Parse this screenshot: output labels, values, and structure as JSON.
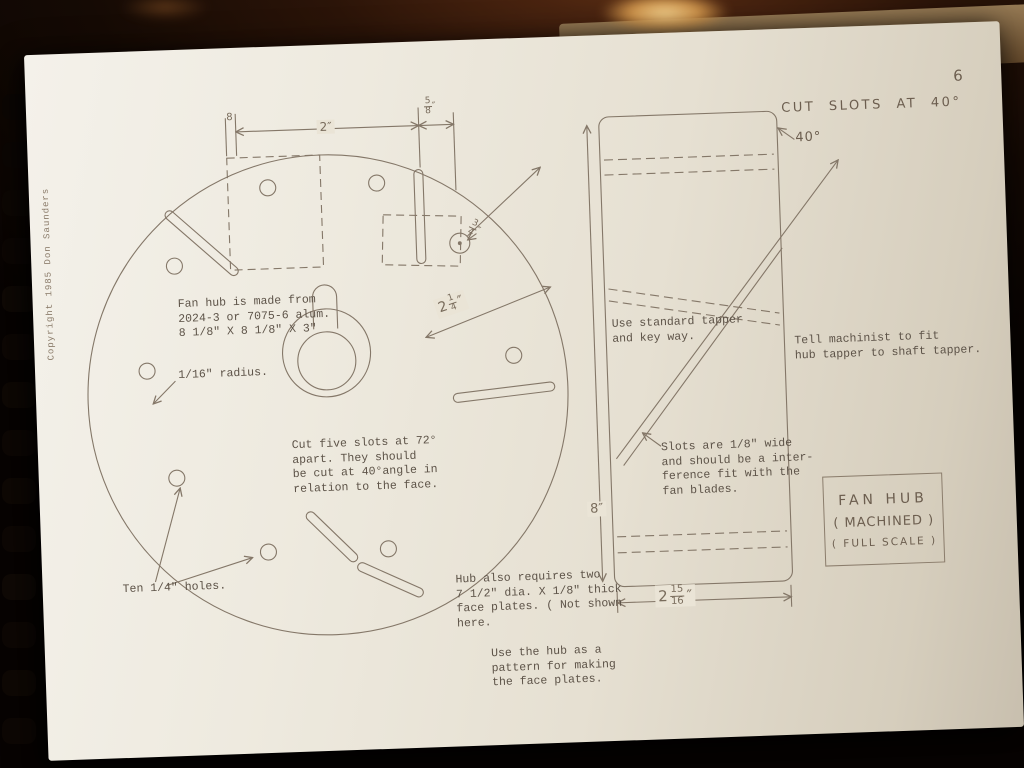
{
  "page_number": "6",
  "copyright": "Copyright 1985 Don Saunders",
  "face_view": {
    "dim_8": "8",
    "dim_2": "2″",
    "dim_5_8": {
      "num": "5",
      "den": "8",
      "unit": "″"
    },
    "dim_3_4": {
      "num": "3",
      "den": "4",
      "unit": "″"
    },
    "dim_2_1_4": {
      "whole": "2",
      "num": "1",
      "den": "4",
      "unit": "″"
    },
    "material_note": "Fan hub is made from\n2024-3 or 7075-6 alum.\n8 1/8\" X 8 1/8\" X 3\"",
    "radius_note": "1/16\" radius.",
    "slots_note": "Cut five slots at 72°\napart.  They should\nbe cut at 40°angle in\nrelation to the face.",
    "holes_note": "Ten 1/4\" holes.",
    "face_plates_note": "Hub also requires two\n7 1/2\" dia. X 1/8\" thick\nface plates. ( Not shown\nhere.",
    "pattern_note": "Use the hub as a\npattern for making\nthe face plates."
  },
  "side_view": {
    "cut_slots_label": "CUT SLOTS AT 40°",
    "angle_label": "40°",
    "tapper_note": "Use standard tapper\nand key way.",
    "machinist_note": "Tell machinist to fit\nhub tapper to shaft tapper.",
    "slot_width_note": "Slots are 1/8\" wide\nand should be a inter-\nference fit with the\nfan blades.",
    "dim_height": "8″",
    "dim_width": {
      "whole": "2",
      "num": "15",
      "den": "16",
      "unit": "″"
    },
    "title_box": {
      "line1": "FAN HUB",
      "line2": "( MACHINED )",
      "line3": "( FULL SCALE )"
    }
  }
}
